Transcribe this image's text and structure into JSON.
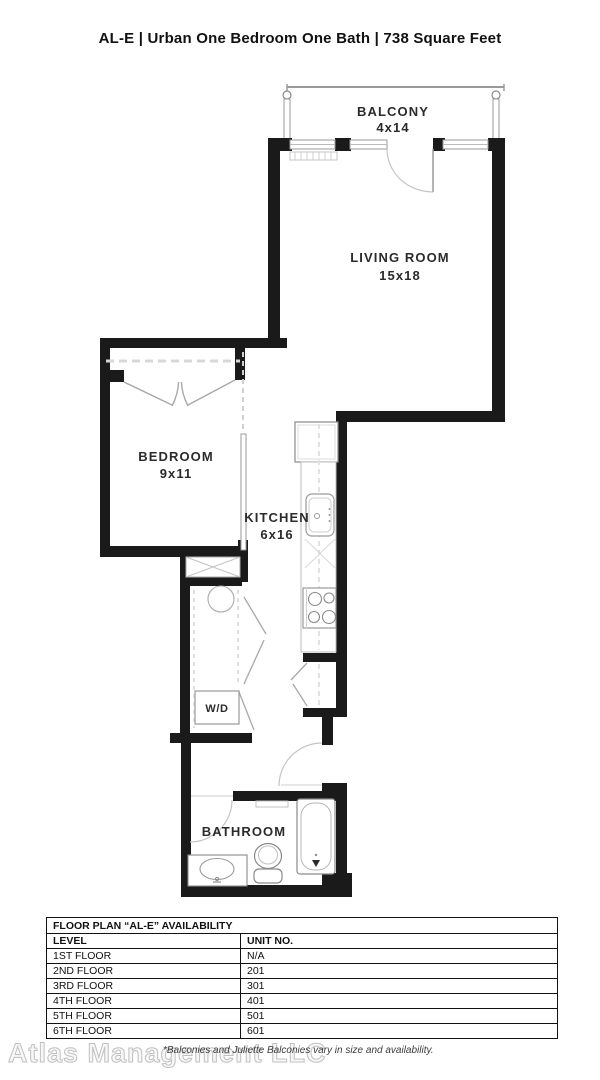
{
  "header": {
    "title": "AL-E | Urban One Bedroom One Bath | 738 Square Feet"
  },
  "floorplan": {
    "balcony": {
      "name": "BALCONY",
      "dim": "4x14"
    },
    "living_room": {
      "name": "LIVING ROOM",
      "dim": "15x18"
    },
    "bedroom": {
      "name": "BEDROOM",
      "dim": "9x11"
    },
    "kitchen": {
      "name": "KITCHEN",
      "dim": "6x16"
    },
    "washer_dryer": {
      "label": "W/D"
    },
    "bathroom": {
      "name": "BATHROOM"
    }
  },
  "availability_table": {
    "title": "FLOOR PLAN “AL-E” AVAILABILITY",
    "columns": [
      "LEVEL",
      "UNIT NO."
    ],
    "rows": [
      [
        "1ST FLOOR",
        "N/A"
      ],
      [
        "2ND FLOOR",
        "201"
      ],
      [
        "3RD FLOOR",
        "301"
      ],
      [
        "4TH FLOOR",
        "401"
      ],
      [
        "5TH FLOOR",
        "501"
      ],
      [
        "6TH FLOOR",
        "601"
      ]
    ]
  },
  "footer": {
    "watermark": "Atlas Management LLC",
    "note": "*Balconies and Juliette Balconies vary in size and availability."
  },
  "colors": {
    "wall": "#1a1a1a",
    "thin_line": "#9a9a9a",
    "light_line": "#cccccc",
    "watermark_outline": "#c0c0c0",
    "text": "#2b2b2b"
  }
}
